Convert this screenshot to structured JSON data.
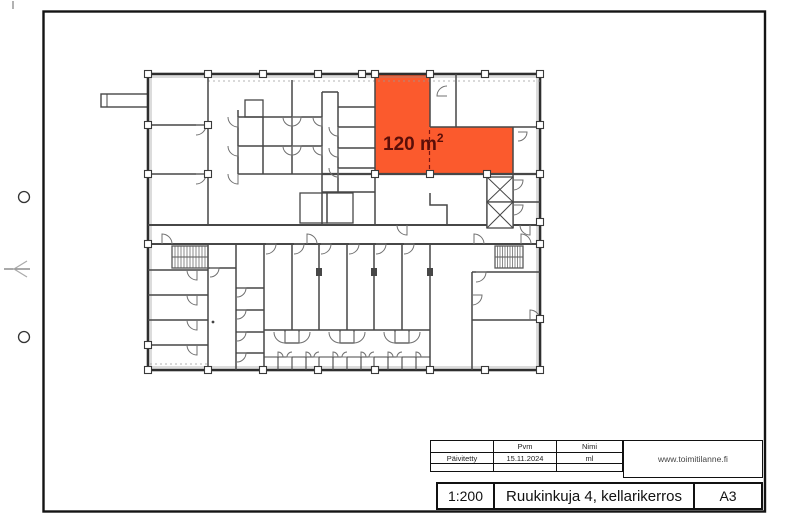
{
  "plan": {
    "highlight": {
      "area_text": "120 m",
      "area_sup": "2"
    },
    "colors": {
      "highlight": "#fb5a2d",
      "area_label": "#5a0e08"
    }
  },
  "title_block": {
    "info_table": {
      "col2_header": "Pvm",
      "col3_header": "Nimi",
      "row2": {
        "col1": "Päivitetty",
        "col2": "15.11.2024",
        "col3": "ml"
      }
    },
    "website": "www.toimitilanne.fi",
    "scale": "1:200",
    "drawing_title": "Ruukinkuja 4, kellarikerros",
    "paper_size": "A3"
  }
}
